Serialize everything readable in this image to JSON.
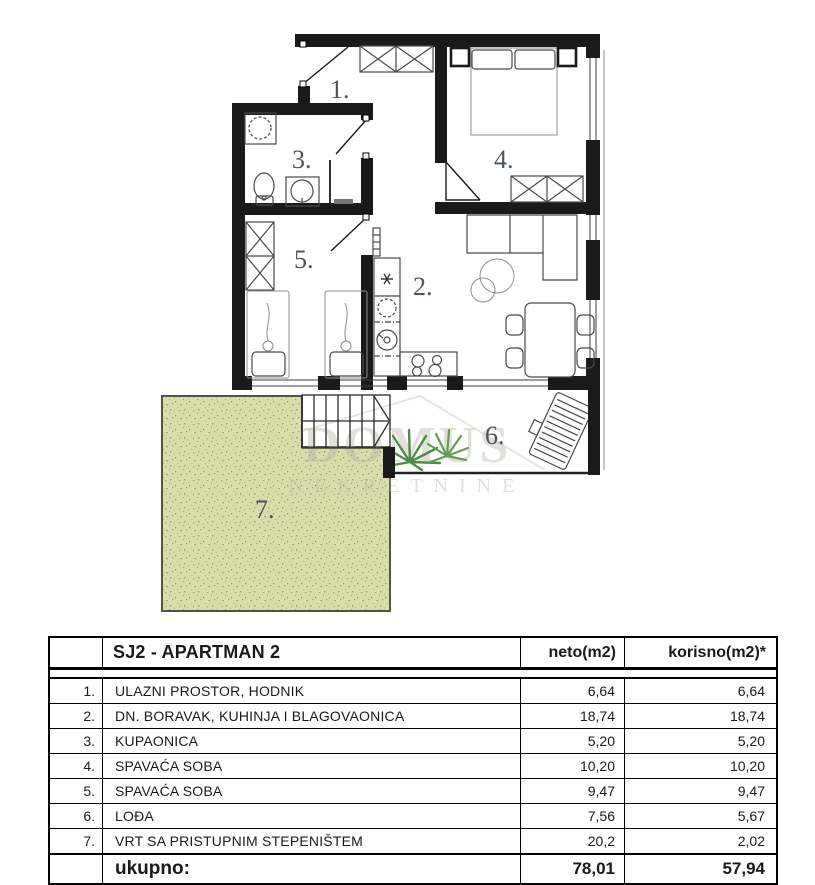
{
  "floor_plan": {
    "room_labels": {
      "r1": "1.",
      "r2": "2.",
      "r3": "3.",
      "r4": "4.",
      "r5": "5.",
      "r6": "6.",
      "r7": "7."
    },
    "watermark": {
      "line1": "DOMUS",
      "line2": "NEKRETNINE"
    },
    "colors": {
      "wall": "#1a1a1a",
      "garden_fill": "#d9dcab",
      "label": "#4b545f"
    }
  },
  "table": {
    "title": "SJ2 - APARTMAN 2",
    "col_neto": "neto(m2)",
    "col_korisno": "korisno(m2)*",
    "rows": [
      {
        "num": "1.",
        "name": "ULAZNI PROSTOR, HODNIK",
        "neto": "6,64",
        "korisno": "6,64"
      },
      {
        "num": "2.",
        "name": "DN. BORAVAK, KUHINJA I BLAGOVAONICA",
        "neto": "18,74",
        "korisno": "18,74"
      },
      {
        "num": "3.",
        "name": "KUPAONICA",
        "neto": "5,20",
        "korisno": "5,20"
      },
      {
        "num": "4.",
        "name": "SPAVAĆA SOBA",
        "neto": "10,20",
        "korisno": "10,20"
      },
      {
        "num": "5.",
        "name": "SPAVAĆA SOBA",
        "neto": "9,47",
        "korisno": "9,47"
      },
      {
        "num": "6.",
        "name": "LOĐA",
        "neto": "7,56",
        "korisno": "5,67"
      },
      {
        "num": "7.",
        "name": "VRT SA PRISTUPNIM STEPENIŠTEM",
        "neto": "20,2",
        "korisno": "2,02"
      }
    ],
    "total_label": "ukupno:",
    "total_neto": "78,01",
    "total_korisno": "57,94"
  }
}
